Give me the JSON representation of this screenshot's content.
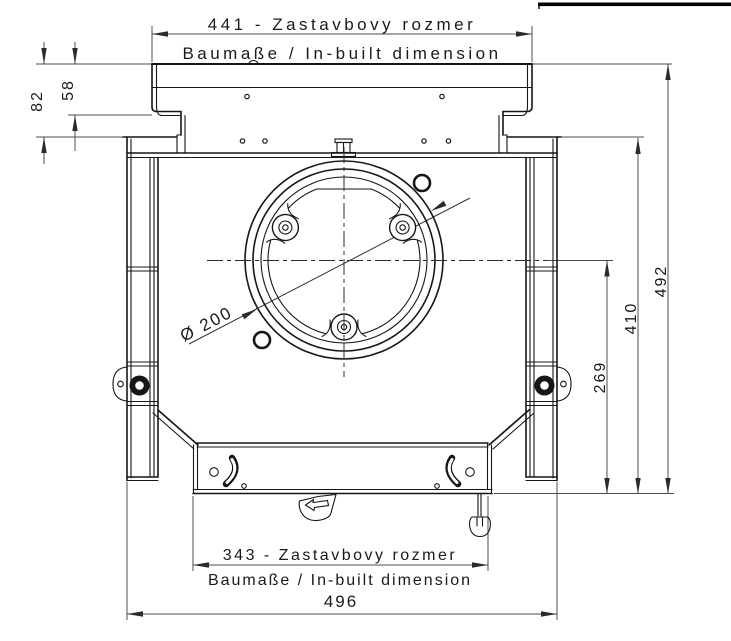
{
  "drawing": {
    "colors": {
      "background": "#ffffff",
      "part_line": "#161616",
      "dimension_line": "#4d4d4d",
      "text": "#1a1a1a"
    },
    "dimensions": {
      "top_width": {
        "value": "441 - Zastavbovy rozmer",
        "note": "Baumaße / In-built dimension"
      },
      "flange_offset_outer": {
        "value": "82"
      },
      "flange_offset_inner": {
        "value": "58"
      },
      "height_overall": {
        "value": "492"
      },
      "height_to_ledge": {
        "value": "410"
      },
      "height_to_axis": {
        "value": "269"
      },
      "spigot_diameter": {
        "value": "Ø 200"
      },
      "bottom_width": {
        "value": "343 - Zastavbovy rozmer",
        "note": "Baumaße / In-built dimension"
      },
      "overall_width": {
        "value": "496"
      }
    }
  }
}
